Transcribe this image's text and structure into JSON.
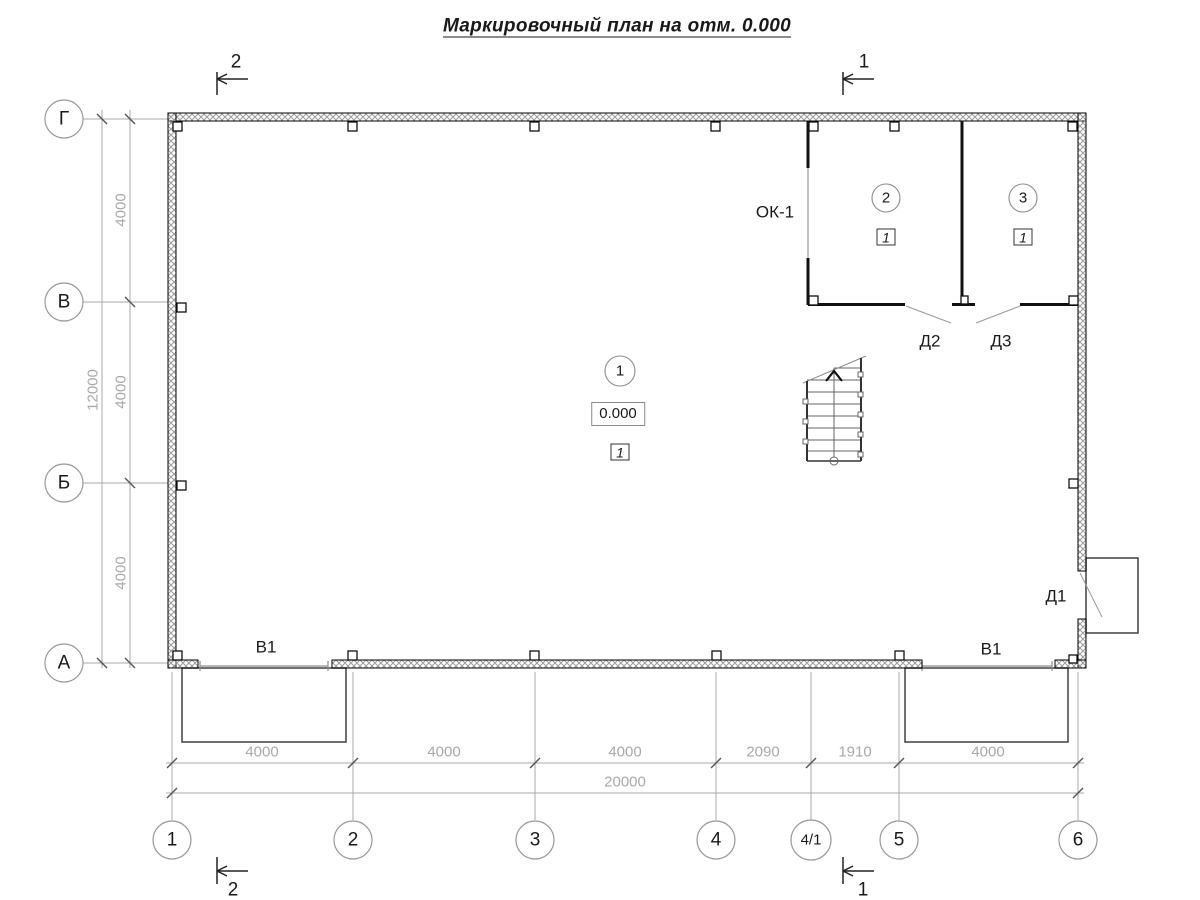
{
  "title": "Маркировочный план на отм. 0.000",
  "axes": {
    "rows": [
      {
        "label": "Г"
      },
      {
        "label": "В"
      },
      {
        "label": "Б"
      },
      {
        "label": "А"
      }
    ],
    "cols": [
      {
        "label": "1"
      },
      {
        "label": "2"
      },
      {
        "label": "3"
      },
      {
        "label": "4"
      },
      {
        "label": "4/1"
      },
      {
        "label": "5"
      },
      {
        "label": "6"
      }
    ]
  },
  "dims": {
    "left": [
      "4000",
      "4000",
      "4000"
    ],
    "left_total": "12000",
    "bottom": [
      "4000",
      "4000",
      "4000",
      "2090",
      "1910",
      "4000"
    ],
    "bottom_total": "20000"
  },
  "rooms": [
    {
      "number": "1",
      "elevation": "0.000",
      "floor_type": "1"
    },
    {
      "number": "2",
      "floor_type": "1"
    },
    {
      "number": "3",
      "floor_type": "1"
    }
  ],
  "labels": {
    "window": "ОК-1",
    "door1": "Д1",
    "door2": "Д2",
    "door3": "Д3",
    "gate_left": "В1",
    "gate_right": "В1"
  },
  "section_marks": {
    "top_left": "2",
    "top_right": "1",
    "bottom_left": "2",
    "bottom_right": "1"
  },
  "colors": {
    "wall_outline": "#000000",
    "wall_hatch": "#9a9a9a",
    "partition": "#111111",
    "dim_gray": "#a9a9a9",
    "tick_dark": "#555555",
    "porch_outline": "#4d4d4d",
    "text": "#1a1a1a"
  }
}
